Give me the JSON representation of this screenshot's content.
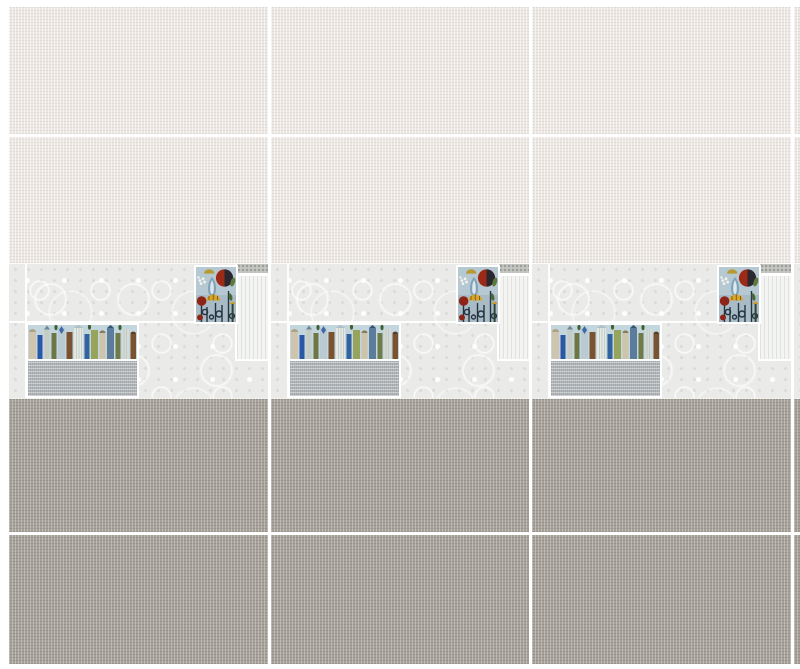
{
  "scene": {
    "kind": "ceramic-wall-tile-visualization",
    "repeat_columns": 3,
    "sections": {
      "top": "two rows of plain cream linen-texture wall tiles",
      "middle": "decor band of white lace-pattern tiles with floral art tile, houses art border tile, gray linen tile, mosaic strip and plain white tile",
      "bottom": "two rows of plain taupe linen-texture wall tiles"
    }
  },
  "colors": {
    "page_bg": "#ffffff",
    "grout": "#ffffff",
    "cream": "#ece7e2",
    "taupe": "#a7a299",
    "lace_base": "#eaeae8",
    "plain_white": "#f4f4f2",
    "gray_linen": "#b3b7ba",
    "mosaic": "#c6c8c4",
    "art_sky": "#c3d5dd",
    "art_flower_bg": "#b6c8d2",
    "art_red": "#9c2a16",
    "art_maroon": "#8e2318",
    "art_dark": "#2b2731",
    "art_yellow": "#d9a62b",
    "art_blue": "#2b58a4",
    "art_olive": "#6d7745",
    "art_brown": "#7b5230"
  }
}
